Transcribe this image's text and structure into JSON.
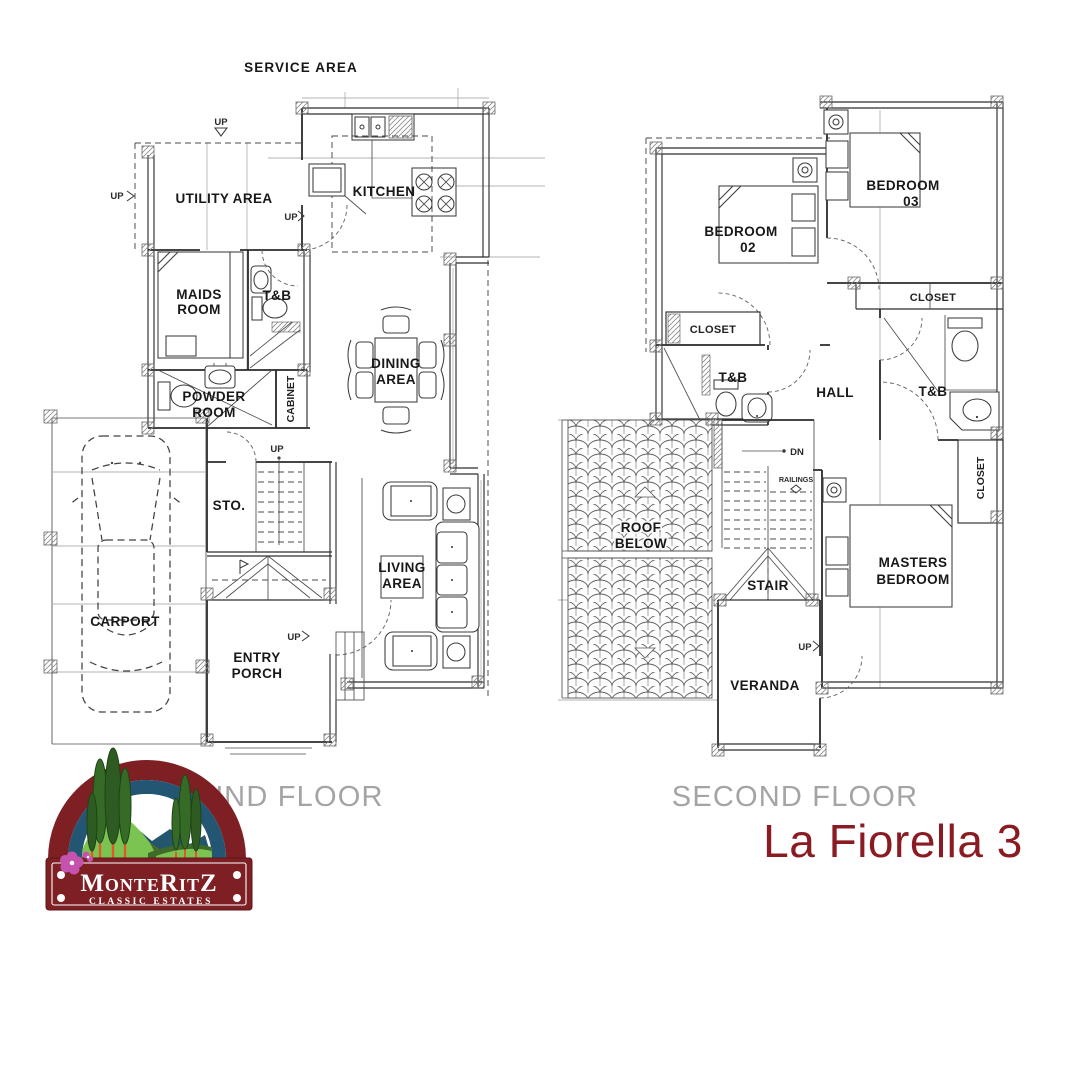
{
  "page": {
    "background": "#ffffff"
  },
  "title": {
    "text": "La Fiorella 3",
    "color": "#8B1B22"
  },
  "ground_floor": {
    "name": "GROUND FLOOR",
    "labels": {
      "service_area": "SERVICE AREA",
      "utility_area": "UTILITY AREA",
      "kitchen": "KITCHEN",
      "maids_room": [
        "MAIDS",
        "ROOM"
      ],
      "tb": "T&B",
      "powder_room": [
        "POWDER",
        "ROOM"
      ],
      "cabinet": "CABINET",
      "dining_area": [
        "DINING",
        "AREA"
      ],
      "sto": "STO.",
      "living_area": [
        "LIVING",
        "AREA"
      ],
      "carport": "CARPORT",
      "entry_porch": [
        "ENTRY",
        "PORCH"
      ],
      "up": "UP"
    }
  },
  "second_floor": {
    "name": "SECOND FLOOR",
    "labels": {
      "bedroom_02": [
        "BEDROOM",
        "02"
      ],
      "bedroom_03": [
        "BEDROOM",
        "03"
      ],
      "closet": "CLOSET",
      "tb": "T&B",
      "hall": "HALL",
      "masters_bedroom": [
        "MASTERS",
        "BEDROOM"
      ],
      "roof_below": [
        "ROOF",
        "BELOW"
      ],
      "stair": "STAIR",
      "veranda": "VERANDA",
      "railings": "RAILINGS",
      "dn": "DN",
      "up": "UP"
    }
  },
  "logo": {
    "name": "MonteRitZ",
    "tagline": "CLASSIC ESTATES",
    "colors": {
      "maroon": "#7E1F24",
      "blue": "#235672",
      "green_light": "#7CC452",
      "green_dark": "#3F6B2A",
      "trunk": "#E2572B",
      "flower": "#C553AE"
    }
  }
}
